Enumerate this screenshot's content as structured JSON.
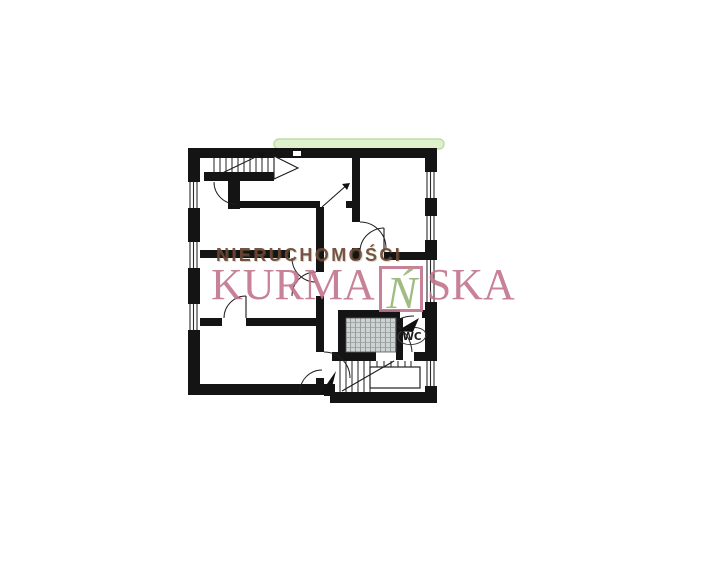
{
  "page": {
    "background_color": "#ffffff"
  },
  "watermark": {
    "line1": "NIERUCHOMOŚCI",
    "brand_prefix": "KURMA",
    "brand_boxed_letter": "Ń",
    "brand_suffix": "SKA",
    "line1_color": "#6e4636",
    "brand_color": "#c3758d",
    "boxed_letter_color": "#97b575"
  },
  "floorplan": {
    "wc_label": "WC",
    "wall_color": "#141414",
    "bathroom_hatch_color": "#8d9494",
    "highlight_color": "#def0cc",
    "highlight_edge_color": "#b5da96"
  }
}
